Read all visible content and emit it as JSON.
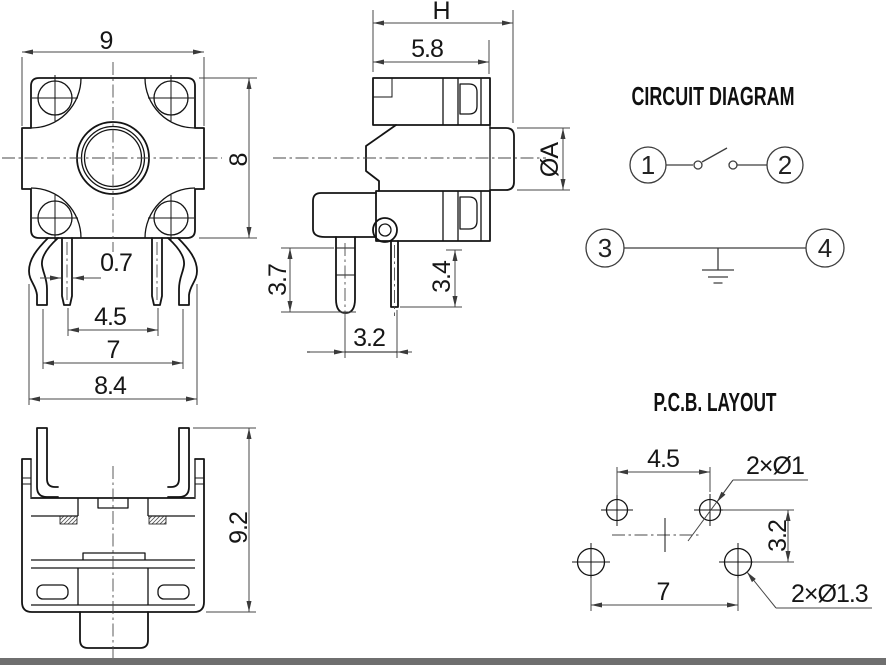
{
  "page": {
    "background": "#ffffff",
    "line_color": "#141414",
    "dim_color": "#474747",
    "footer_bar_color": "#6f6f6f"
  },
  "top_view": {
    "dims": {
      "width": "9",
      "height": "8",
      "pin_width": "0.7",
      "inner_pin_pitch": "4.5",
      "outer_pin_pitch": "7",
      "pin_span": "8.4"
    }
  },
  "side_view": {
    "dims": {
      "total_height": "H",
      "body_depth": "5.8",
      "stem_diameter": "ØA",
      "peg_length": "3.7",
      "terminal_length": "3.4",
      "peg_to_terminal": "3.2"
    }
  },
  "front_view": {
    "dims": {
      "overall_height": "9.2"
    }
  },
  "circuit_diagram": {
    "title": "CIRCUIT DIAGRAM",
    "terminal_1": "1",
    "terminal_2": "2",
    "terminal_3": "3",
    "terminal_4": "4"
  },
  "pcb_layout": {
    "title": "P.C.B. LAYOUT",
    "dims": {
      "top_hole_pitch": "4.5",
      "small_hole_note": "2×Ø1",
      "row_pitch": "3.2",
      "bottom_hole_pitch": "7",
      "large_hole_note": "2×Ø1.3"
    }
  }
}
